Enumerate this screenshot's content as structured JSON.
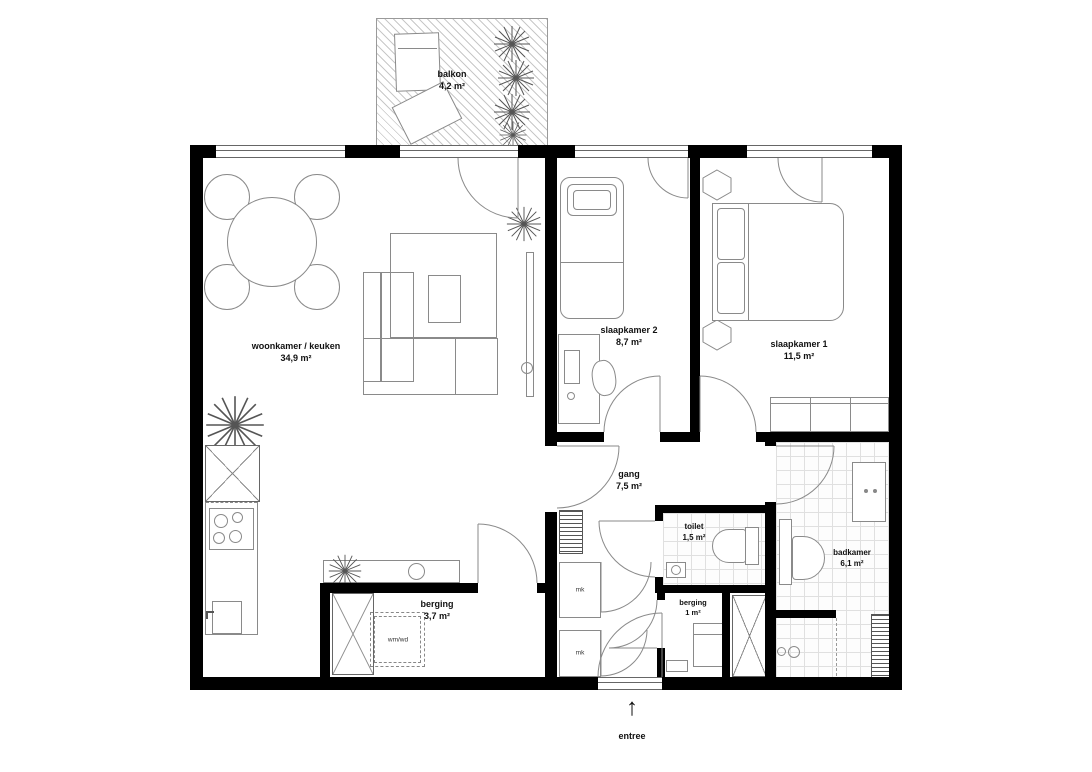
{
  "rooms": {
    "balkon": {
      "name": "balkon",
      "area": "4,2 m²"
    },
    "woonkamer": {
      "name": "woonkamer / keuken",
      "area": "34,9 m²"
    },
    "slaapkamer2": {
      "name": "slaapkamer 2",
      "area": "8,7 m²"
    },
    "slaapkamer1": {
      "name": "slaapkamer 1",
      "area": "11,5 m²"
    },
    "gang": {
      "name": "gang",
      "area": "7,5 m²"
    },
    "toilet": {
      "name": "toilet",
      "area": "1,5 m²"
    },
    "badkamer": {
      "name": "badkamer",
      "area": "6,1 m²"
    },
    "berging_groot": {
      "name": "berging",
      "area": "3,7 m²"
    },
    "berging_klein": {
      "name": "berging",
      "area": "1 m²"
    }
  },
  "entrance": {
    "label": "entree",
    "arrow": "↑"
  },
  "labels": {
    "washer": "wm/wd",
    "meter_closet": "mk"
  },
  "colors": {
    "wall": "#000000",
    "furniture_line": "#8a8a8a",
    "tile_line": "#e0e0e0",
    "hatch_line": "#c8c8c8",
    "text": "#111111",
    "background": "#ffffff"
  }
}
